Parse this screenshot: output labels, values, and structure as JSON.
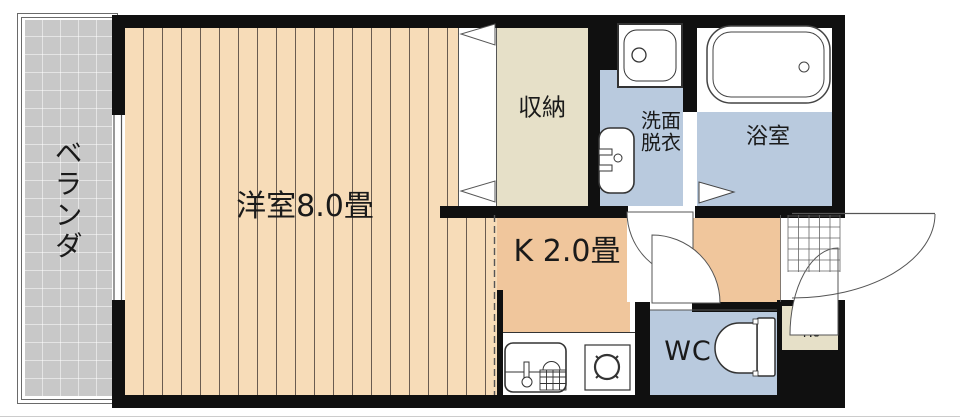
{
  "plan_title": "1K apartment floor plan",
  "rooms": {
    "veranda": {
      "label": "ベランダ"
    },
    "main_room": {
      "label": "洋室8.0畳"
    },
    "closet": {
      "label": "収納"
    },
    "washroom": {
      "label_line1": "洗面",
      "label_line2": "脱衣"
    },
    "bathroom": {
      "label": "浴室"
    },
    "kitchen": {
      "label": "K 2.0畳"
    },
    "wc": {
      "label": "WC"
    },
    "shoe_box": {
      "label": "靴"
    }
  },
  "fixtures": [
    "washing-machine-pan",
    "washbasin",
    "bathtub",
    "kitchen-sink",
    "stove",
    "toilet",
    "entrance-door",
    "room-doors",
    "closet-folding-door"
  ],
  "colors": {
    "wall": "#101010",
    "floor_wood": "#f7dcb8",
    "floor_stripe": "#6a5c50",
    "kitchen": "#f0c69c",
    "wet": "#b9cade",
    "storage": "#e6e0c8",
    "veranda": "#c8c8c8",
    "line": "#444444"
  }
}
